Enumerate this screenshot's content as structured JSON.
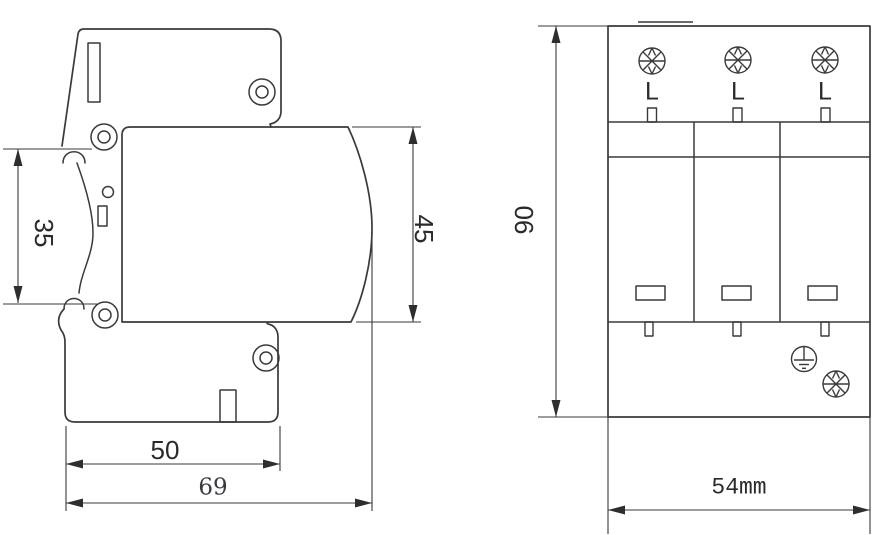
{
  "side_view": {
    "rail_height_mm": "35",
    "body_height_mm": "45",
    "body_depth_mm": "50",
    "total_depth_mm": "69"
  },
  "front_view": {
    "total_height_mm": "90",
    "total_width": "54mm",
    "terminal_labels": [
      "L",
      "L",
      "L"
    ]
  },
  "icons": {
    "screw_head": "cross-slot terminal screw head",
    "earth_terminal": "protective earth (ground) symbol",
    "mounting_hole": "double-circle screw hole"
  },
  "colors": {
    "line": "#3a3a3a",
    "arrow": "#2e2e2e",
    "background": "#ffffff"
  }
}
